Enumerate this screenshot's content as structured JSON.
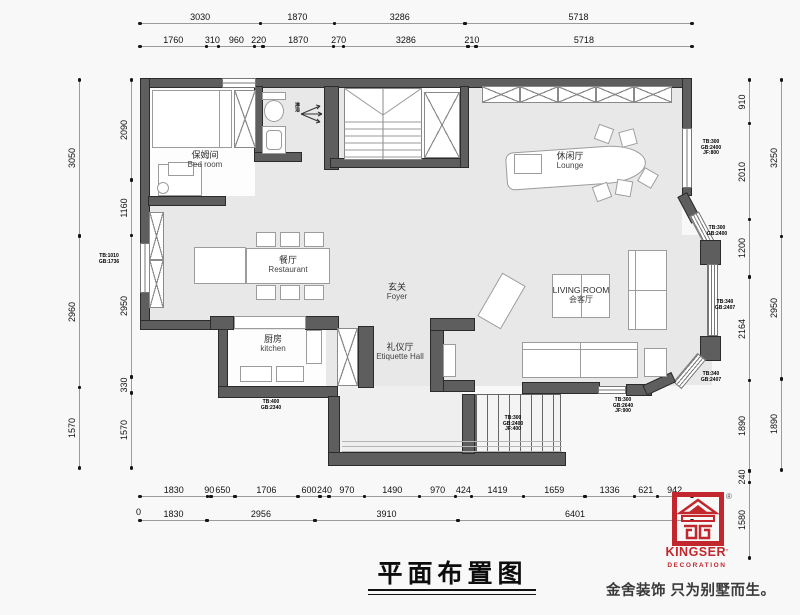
{
  "title": {
    "text": "平面布置图"
  },
  "rooms": {
    "bedroom": {
      "cn": "保姆间",
      "en": "Bed room"
    },
    "lounge": {
      "cn": "休闲厅",
      "en": "Lounge"
    },
    "restaurant": {
      "cn": "餐厅",
      "en": "Restaurant"
    },
    "foyer": {
      "cn": "玄关",
      "en": "Foyer"
    },
    "living": {
      "line1": "LIVING ROOM",
      "line2": "会客厅"
    },
    "kitchen": {
      "cn": "厨房",
      "en": "kitchen"
    },
    "etiquette": {
      "cn": "礼仪厅",
      "en": "Etiquette Hall"
    },
    "shower": {
      "cn": "淋浴"
    }
  },
  "dims": {
    "top_row1": [
      "3030",
      "1870",
      "3286",
      "5718"
    ],
    "top_row2": [
      "1760",
      "310",
      "960",
      "220",
      "1870",
      "270",
      "3286",
      "210",
      "5718"
    ],
    "bottom_row1": [
      "1830",
      "90",
      "650",
      "1706",
      "600",
      "240",
      "970",
      "1490",
      "970",
      "424",
      "1419",
      "1659",
      "1336",
      "621",
      "942"
    ],
    "bottom_row2": [
      "1830",
      "2956",
      "3910",
      "6401"
    ],
    "bottom_zero": "0",
    "left_outer": [
      "3050",
      "2960",
      "1570"
    ],
    "left_inner": [
      "2090",
      "1160",
      "2950",
      "330",
      "1570"
    ],
    "right_inner": [
      "910",
      "2010",
      "1200",
      "2164",
      "1890",
      "240",
      "1580"
    ],
    "right_outer": [
      "3250",
      "2950",
      "1890"
    ]
  },
  "annotations": [
    {
      "lines": [
        "TB:1010",
        "GB:1736"
      ]
    },
    {
      "lines": [
        "TB:300",
        "GB:2400",
        "JF:800"
      ]
    },
    {
      "lines": [
        "TB:300",
        "GB:2400"
      ]
    },
    {
      "lines": [
        "TB:340",
        "GB:2407"
      ]
    },
    {
      "lines": [
        "TB:340",
        "GB:2407"
      ]
    },
    {
      "lines": [
        "TB:400",
        "GB:2340"
      ]
    },
    {
      "lines": [
        "TB:300",
        "GB:2400",
        "JF:400"
      ]
    },
    {
      "lines": [
        "TB:300",
        "GB:2640",
        "JF:900"
      ]
    }
  ],
  "logo": {
    "brand": "KINGSER",
    "mark": "’",
    "reg": "®",
    "sub": "DECORATION",
    "tagline": "金舍装饰 只为别墅而生。",
    "color": "#c1272d"
  }
}
